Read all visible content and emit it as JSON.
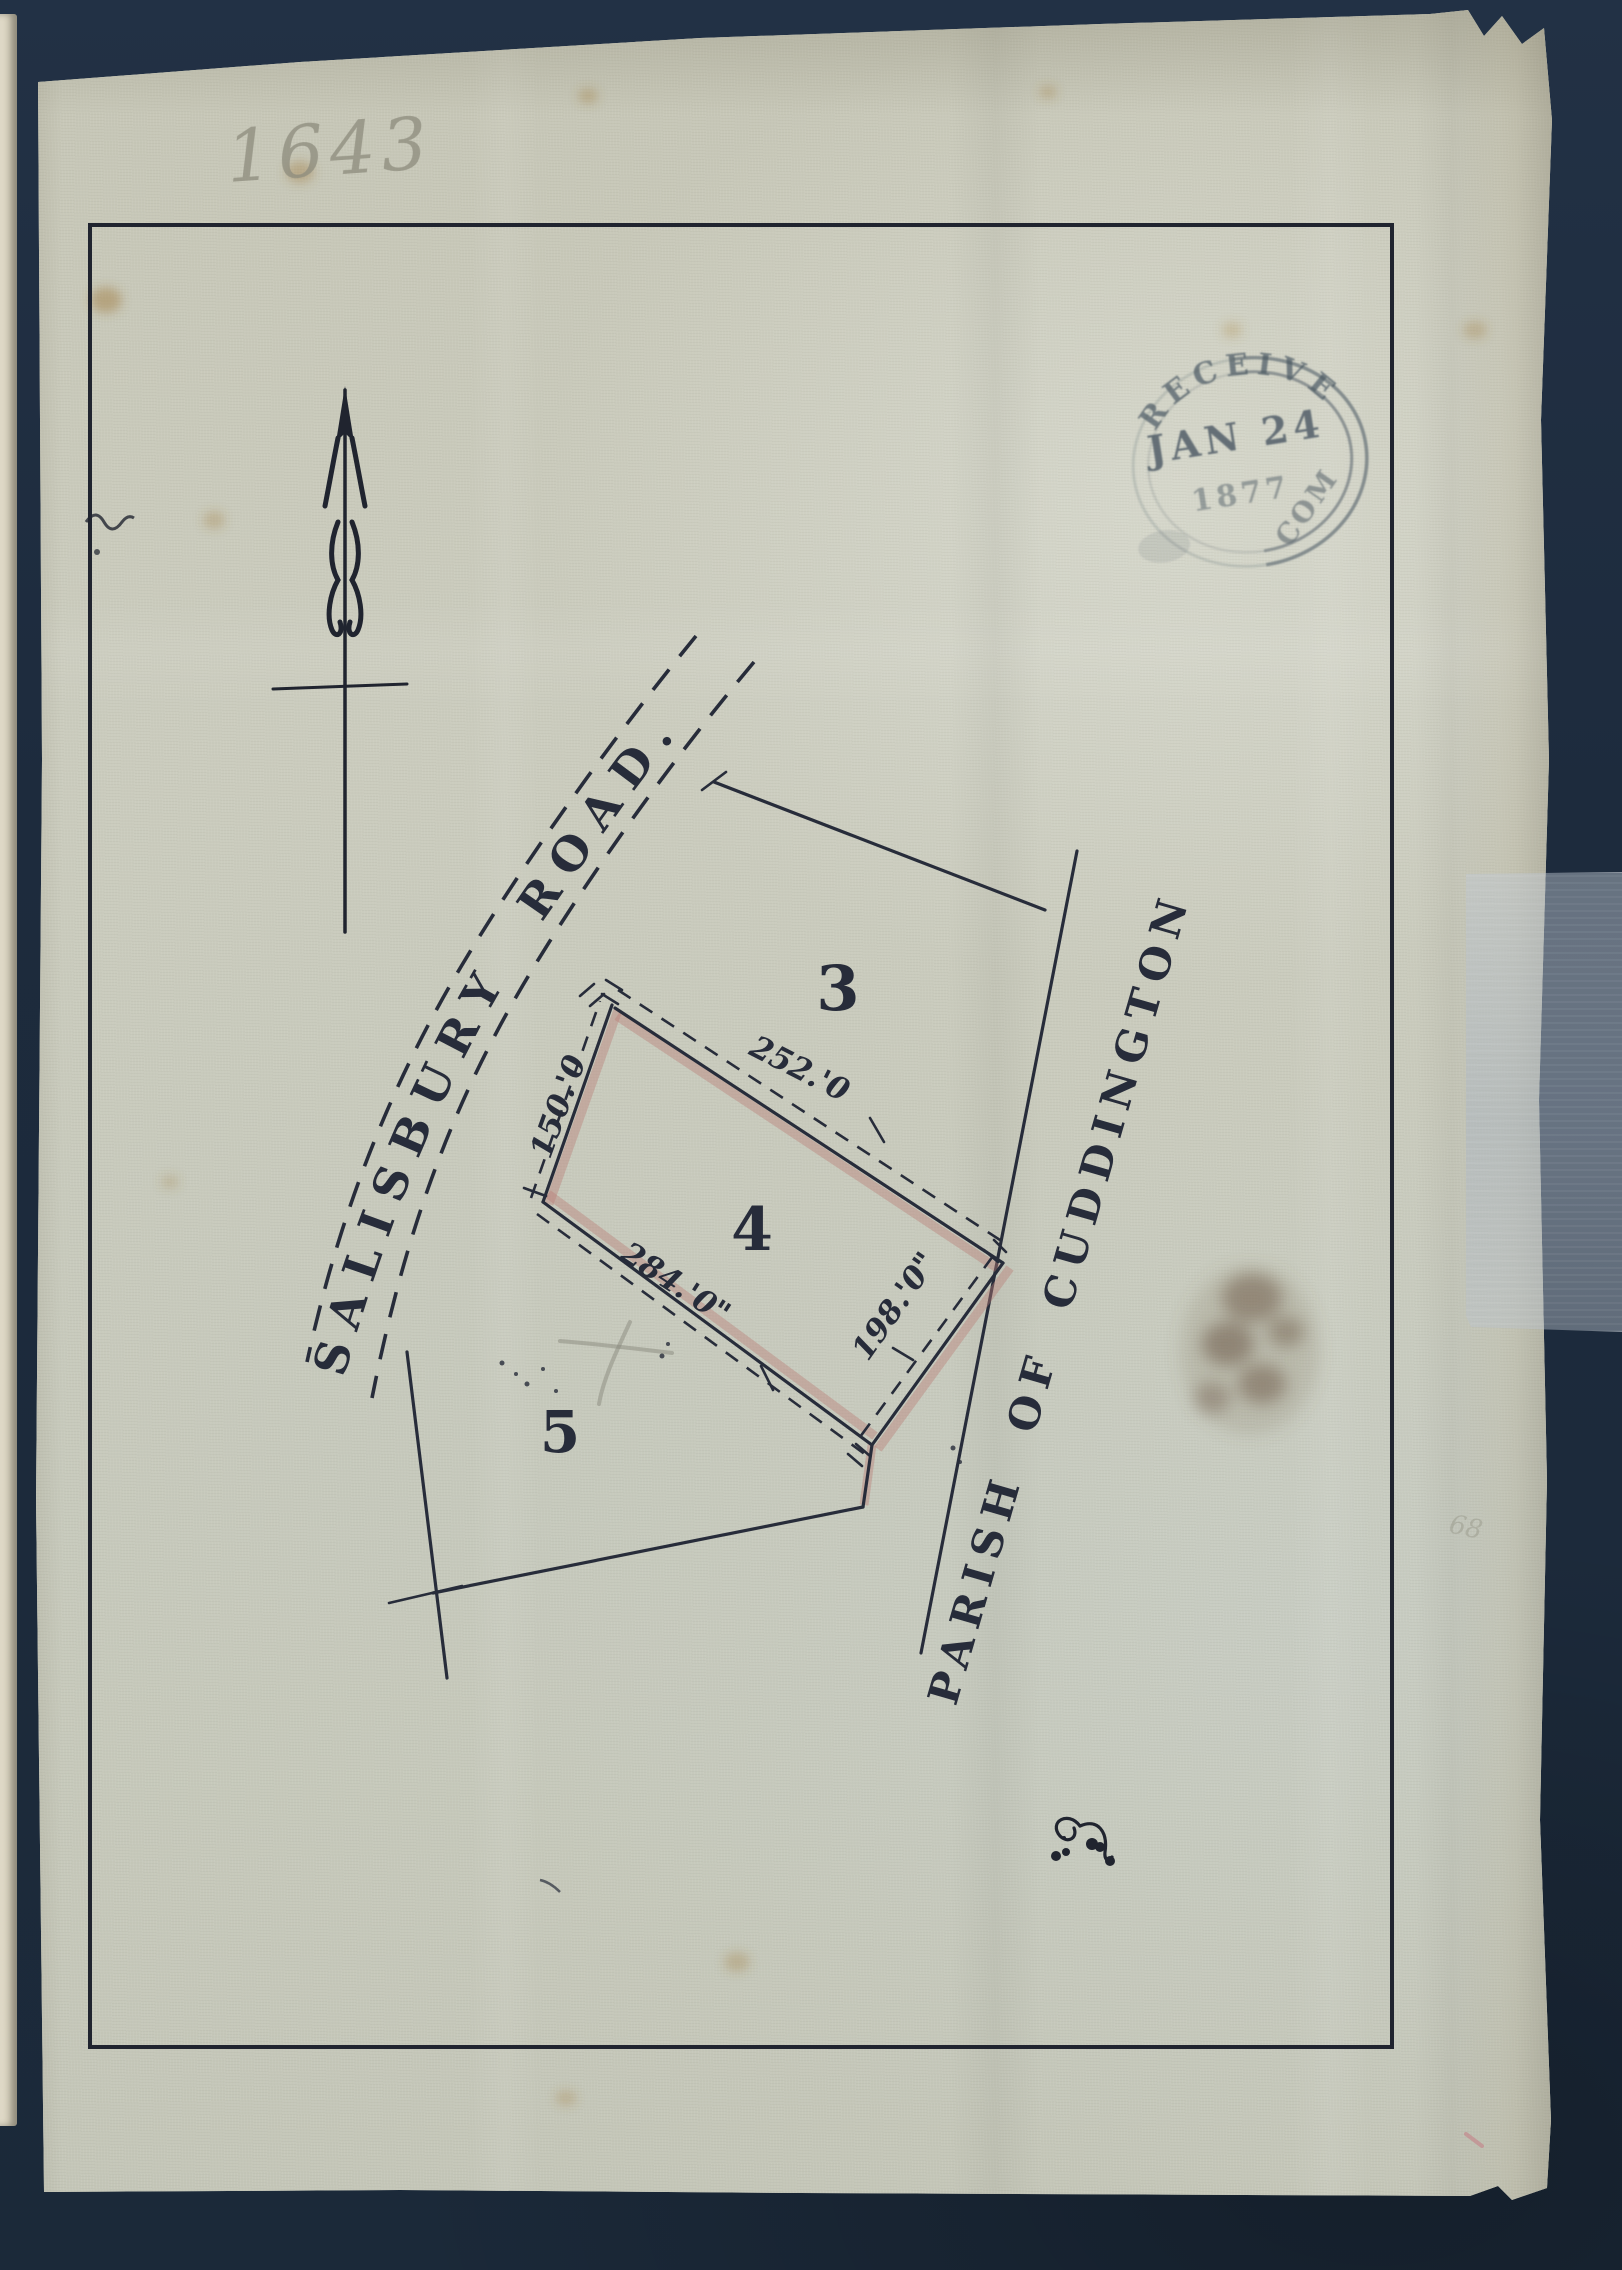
{
  "document": {
    "pencil_number": "1643",
    "margin_pencil_number": "68",
    "stamp": {
      "arc_top": "RECEIVED",
      "date": "JAN 24",
      "year": "1877",
      "arc_bottom_fragment": "COM"
    },
    "map": {
      "road_label": "SALISBURY ROAD.",
      "parish_label": "PARISH OF CUDDINGTON",
      "plot_labels": [
        "3",
        "4",
        "5"
      ],
      "dimensions": {
        "north_edge": "252.'0",
        "west_edge": "150.'0",
        "southwest_edge": "284.'0\"",
        "southeast_edge": "198.'0\""
      }
    },
    "colors": {
      "background_navy": "#1d2b3d",
      "paper": "#cbccbe",
      "ink": "#272c3a",
      "edge_shading_pink": "#b97f78",
      "stamp_ink": "#46545f",
      "pencil": "#8c8b7d"
    }
  }
}
